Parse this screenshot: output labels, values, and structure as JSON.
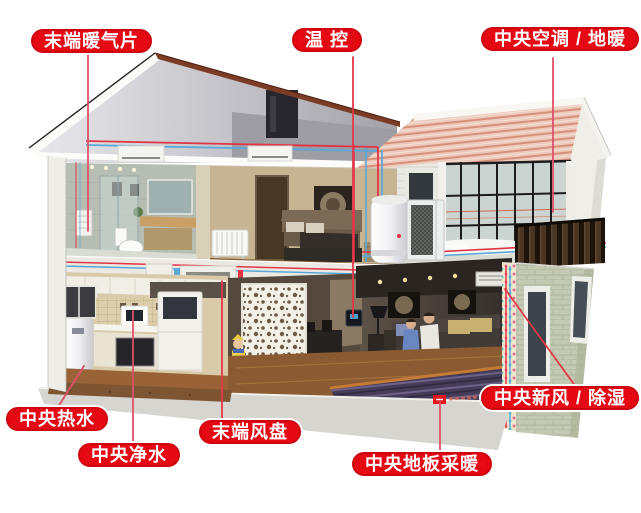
{
  "labels": [
    {
      "id": "terminal-radiator",
      "text": "末端暖气片"
    },
    {
      "id": "temperature-control",
      "text": "温 控"
    },
    {
      "id": "central-ac-floor-heating",
      "text": "中央空调 / 地暖"
    },
    {
      "id": "central-hot-water",
      "text": "中央热水"
    },
    {
      "id": "central-water-purifier",
      "text": "中央净水"
    },
    {
      "id": "terminal-fan-coil",
      "text": "末端风盘"
    },
    {
      "id": "central-floor-radiant-heating",
      "text": "中央地板采暖"
    },
    {
      "id": "central-fresh-air-dehumidifier",
      "text": "中央新风 / 除湿"
    }
  ],
  "colors": {
    "label_bg": "#e50914",
    "label_border": "#cf040e",
    "label_text": "#ffffff",
    "pointer_line": "#e0506a",
    "pipe_hot": "#e03545",
    "pipe_cold": "#58a8d8",
    "roof_tile": "#eccabc"
  }
}
